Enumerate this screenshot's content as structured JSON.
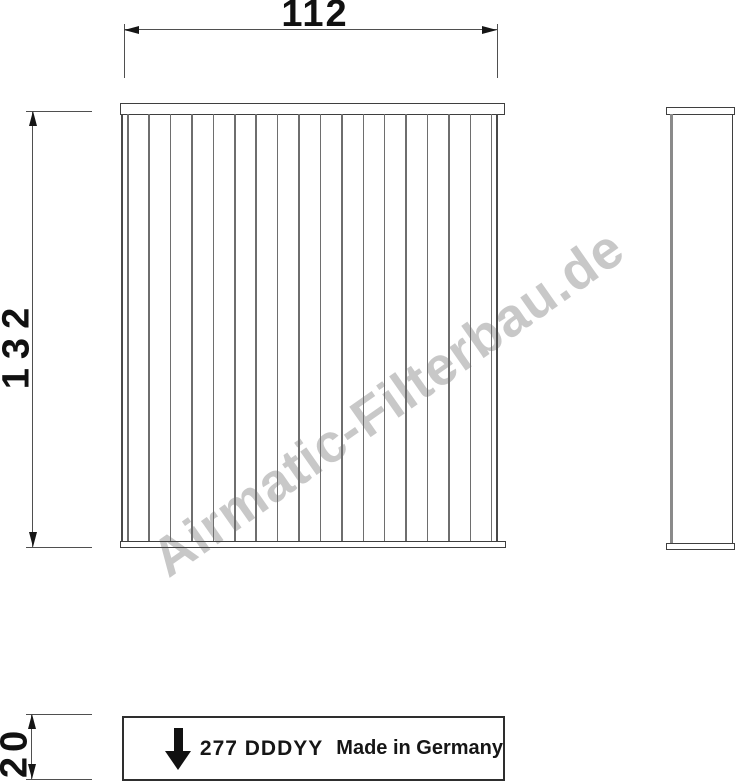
{
  "watermark": {
    "text": "Airmatic-Filterbau.de"
  },
  "dimensions": {
    "width": {
      "value": "112"
    },
    "height": {
      "value": "132"
    },
    "depth": {
      "value": "20"
    }
  },
  "label_box": {
    "part_number": "277 DDDYY",
    "origin": "Made in Germany",
    "airflow_icon": "down-arrow"
  },
  "drawing": {
    "views": [
      "front-pleated-view",
      "side-profile-view",
      "bottom-edge-label-view"
    ],
    "front_view": {
      "pleat_line_count": 18,
      "pleat_spacing_px": 21.41
    },
    "colors": {
      "outline": "#3f3f3f",
      "pleat_line": "#6e6e6e",
      "dimension_line": "#4f4f4f",
      "text": "#111111",
      "watermark": "#c8c8c8"
    }
  }
}
